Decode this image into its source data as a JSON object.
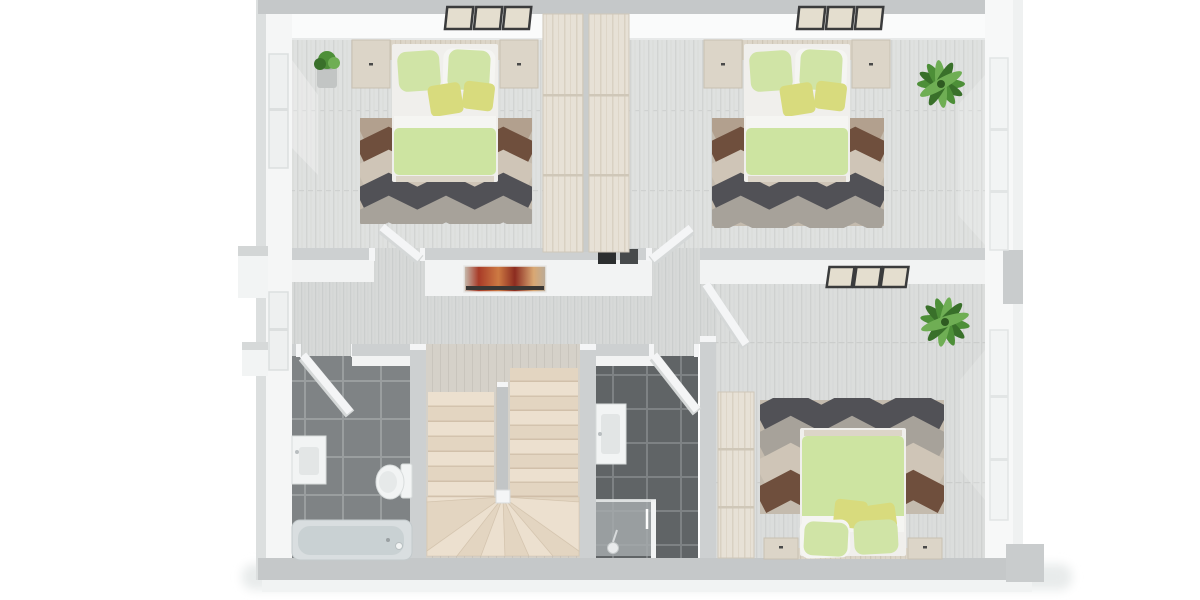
{
  "scene": {
    "type": "3d-floor-plan-top-down-render",
    "description": "Rendered upper-floor plan with three bedrooms, two bathrooms, hallway and U-shaped staircase",
    "rooms": [
      {
        "name": "bedroom-top-left",
        "items": [
          "double-bed",
          "green-duvet",
          "green-pillows",
          "yellow-cushions",
          "headboard-bench",
          "nightstand-left",
          "nightstand-right",
          "chevron-rug",
          "potted-plant",
          "three-wall-frames",
          "tall-wardrobe",
          "window-left-wall"
        ]
      },
      {
        "name": "bedroom-top-right",
        "items": [
          "double-bed",
          "green-duvet",
          "green-pillows",
          "yellow-cushions",
          "headboard-bench",
          "nightstand-left",
          "nightstand-right",
          "chevron-rug",
          "palm-plant",
          "three-wall-frames",
          "tall-wardrobe",
          "window-right-wall"
        ]
      },
      {
        "name": "hallway",
        "items": [
          "abstract-red-wall-art",
          "wall-niche-panels",
          "doors-to-all-rooms"
        ]
      },
      {
        "name": "bathroom-left",
        "items": [
          "vanity-sink",
          "toilet",
          "bathtub",
          "dark-tile-floor",
          "door"
        ]
      },
      {
        "name": "staircase",
        "items": [
          "u-shaped-stair",
          "left-flight",
          "right-flight",
          "winder-steps",
          "newel-post"
        ]
      },
      {
        "name": "bathroom-middle",
        "items": [
          "vanity-sink",
          "walk-in-shower",
          "shower-head",
          "dark-tile-floor",
          "door"
        ]
      },
      {
        "name": "bedroom-bottom-right",
        "items": [
          "double-bed",
          "green-duvet",
          "green-pillows",
          "yellow-cushions",
          "headboard-bench",
          "nightstands",
          "chevron-rug",
          "palm-plant",
          "three-wall-frames",
          "tall-wardrobe",
          "window-right-wall",
          "door"
        ]
      }
    ]
  },
  "colors": {
    "wall_top": "#c5c8c9",
    "wall_top_light": "#cdd0d1",
    "wall_face": "#f2f3f3",
    "wall_face_bright": "#fafbfb",
    "wall_outer": "#dcdfdf",
    "door": "#f4f5f6",
    "door_edge": "#d5d8d8",
    "duvet": "#cde4a1",
    "pillow": "#d0e4a6",
    "cushion": "#d8db7d",
    "sheet": "#f5f5f2",
    "wood": "#dcd5c8",
    "rug_base": "#c4bbae",
    "rug_brown": "#6f4f3d",
    "rug_taupe": "#b2a08e",
    "rug_beige": "#cfc5b7",
    "rug_dark": "#515156",
    "rug_gray": "#a7a29a",
    "stair_tread": "#ece0cf",
    "stair_tread_alt": "#e3d5c1",
    "stair_shadow": "#c9b7a0",
    "plant": "#4d8f38",
    "plant_dark": "#39702a",
    "plant_light": "#6fae54",
    "pot": "#c2c5c4",
    "porcelain": "#f2f4f4",
    "tub": "#d9dee0",
    "tub_inner": "#c9d1d3",
    "glass": "#a7adaf",
    "art_red": "#a83b28",
    "art_orange": "#cd7a43",
    "art_dark": "#3a3734",
    "frame": "#3a3b3c",
    "frame_fill": "#e4decf",
    "niche_dark": "#2c2e2f",
    "niche_mid": "#474a4b",
    "shadow": "#e8ebeb"
  }
}
